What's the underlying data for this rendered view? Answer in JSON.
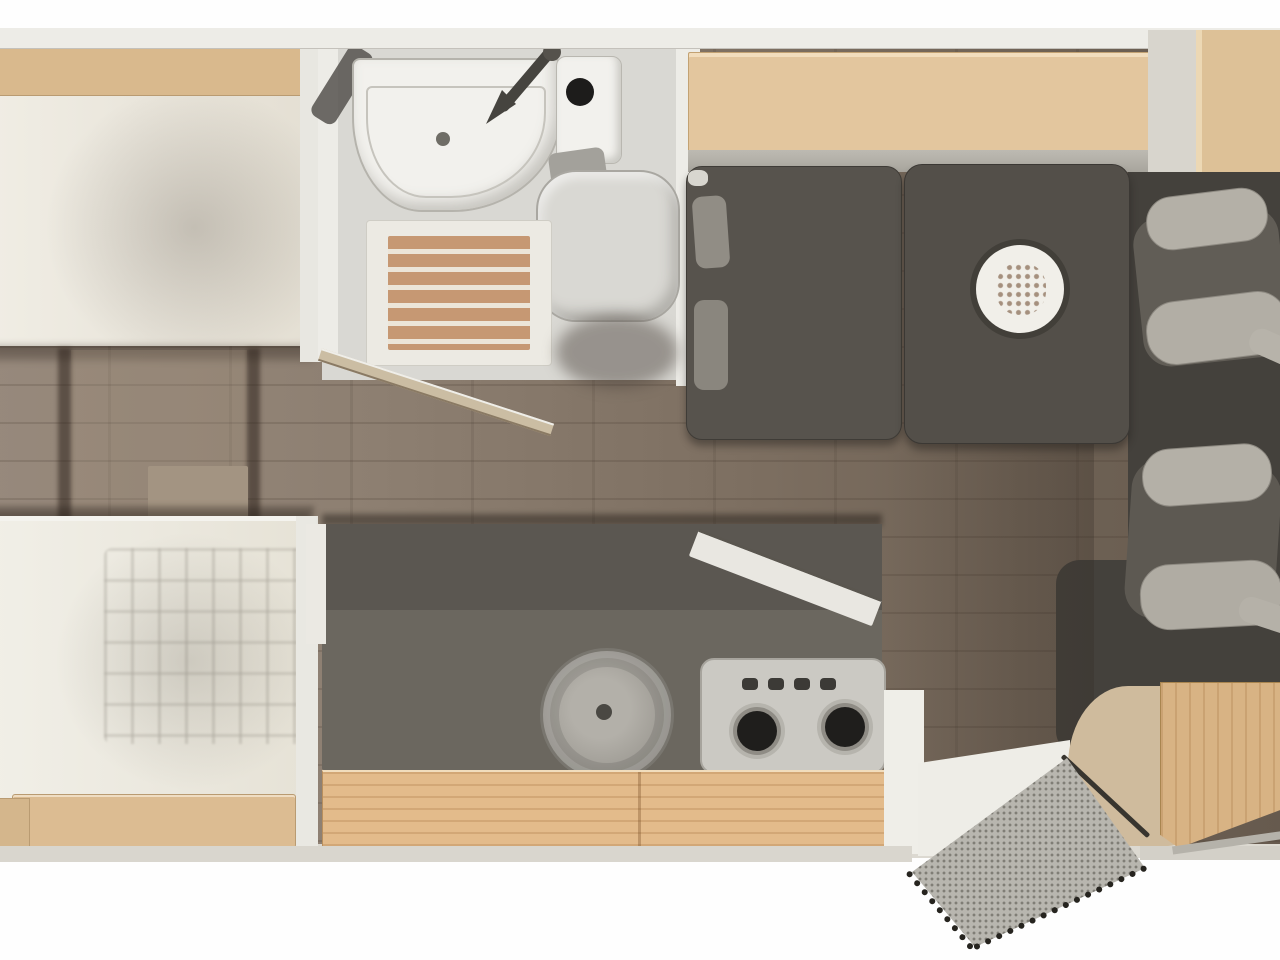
{
  "floorplan": {
    "title": "motorhome interior floor plan, top-down view",
    "orientation": "cab on the right, rear bedroom on the left, entry door at bottom right",
    "zones": {
      "rear_bedroom": {
        "name": "rear bedroom",
        "items": [
          "single bed (top)",
          "single bed (bottom)",
          "headboard wood shelf",
          "footboard wood shelf",
          "step platform between beds",
          "quilted duvet"
        ]
      },
      "bathroom": {
        "name": "bathroom",
        "items": [
          "washbasin",
          "tap",
          "toilet cassette with flush",
          "toilet lid",
          "shower duckboard (wood slats)",
          "open bathroom door"
        ]
      },
      "kitchen": {
        "name": "kitchen",
        "items": [
          "dark worktop",
          "round sink with drain",
          "gas hob (2 burners)",
          "4 control knobs",
          "wood drawer front",
          "flip-up worktop extension"
        ]
      },
      "dinette": {
        "name": "dinette",
        "items": [
          "overhead wood sideboard",
          "wood side cabinet",
          "bench seat with back cushions",
          "pedestal table",
          "dinner plate with food"
        ]
      },
      "cab": {
        "name": "cab",
        "items": [
          "passenger swivel seat",
          "driver swivel seat"
        ]
      },
      "entrance": {
        "name": "entrance",
        "items": [
          "open entry door",
          "speckled entry mat with dotted trim",
          "curved entry step",
          "wood step box"
        ]
      }
    },
    "palette": {
      "wall": "#dcd9d1",
      "wall_light": "#edece7",
      "floor_a": "#97897c",
      "floor_b": "#665a4e",
      "wood_shelf": "#e3c69e",
      "wood_rail": "#d9b98d",
      "wood_kitchen": "#e3bb8b",
      "wood_cabinet": "#ddc197",
      "mattress": "#eae6dc",
      "bathfloor": "#d9d8d3",
      "fixture": "#f2f1ed",
      "duckboard": "#c69873",
      "darkgray": "#534f49",
      "charcoal": "#44413c",
      "seat": "#5d5952",
      "seatlight": "#b4b0a7",
      "counter": "#6b675f",
      "counterdark": "#5b5751",
      "hob": "#cbc9c3",
      "burner": "#1f1e1c",
      "plate": "#f1efe9",
      "food": "#c08a5a",
      "mat": "#b8b6af",
      "doorwood": "#d7b288"
    }
  }
}
